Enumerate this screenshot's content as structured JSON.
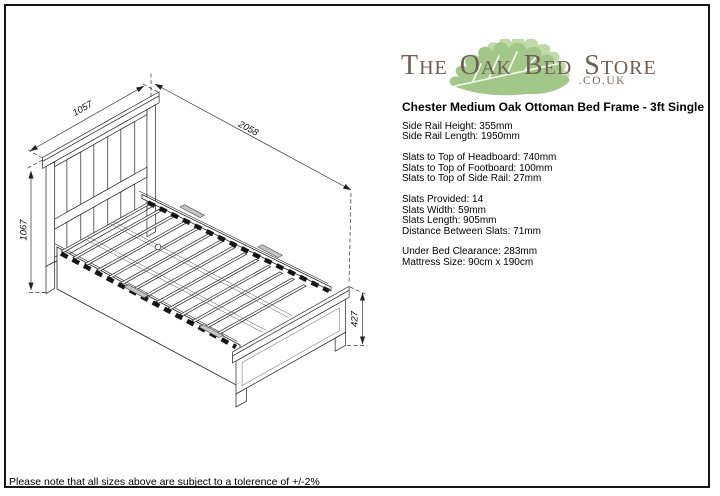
{
  "page": {
    "note": "Please note that all sizes above are subject to a tolerence of +/-2%"
  },
  "logo": {
    "parts": [
      {
        "lead": "T",
        "rest": "HE"
      },
      {
        "lead": "O",
        "rest": "AK"
      },
      {
        "lead": "B",
        "rest": "ED"
      },
      {
        "lead": "S",
        "rest": "TORE"
      }
    ],
    "suffix": ".CO.UK",
    "colors": {
      "text": "#6e6057",
      "leaf_front": "#a2c789",
      "leaf_back": "#c0daab"
    }
  },
  "product": {
    "title": "Chester Medium Oak Ottoman Bed Frame - 3ft Single"
  },
  "specs": {
    "groups": [
      {
        "lines": [
          "Side Rail Height: 355mm",
          "Side Rail Length: 1950mm"
        ]
      },
      {
        "lines": [
          "Slats to Top of Headboard: 740mm",
          "Slats to Top of Footboard: 100mm",
          "Slats to Top of Side Rail: 27mm"
        ]
      },
      {
        "lines": [
          "Slats Provided: 14",
          "Slats Width: 59mm",
          "Slats Length: 905mm",
          "Distance Between Slats: 71mm"
        ]
      },
      {
        "lines": [
          "Under Bed Clearance: 283mm",
          "Mattress Size: 90cm x 190cm"
        ]
      }
    ]
  },
  "diagram": {
    "dims": {
      "headboard_width": "1057",
      "bed_length": "2058",
      "headboard_height": "1067",
      "footboard_height": "427"
    }
  }
}
